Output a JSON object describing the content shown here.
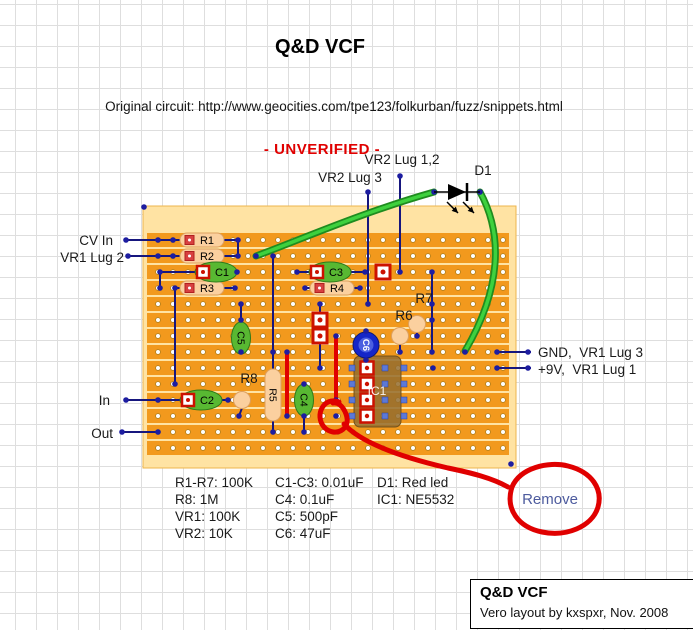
{
  "title": "Q&D VCF",
  "subtitle": "Original circuit: http://www.geocities.com/tpe123/folkurban/fuzz/snippets.html",
  "status": "- UNVERIFIED -",
  "remove_label": "Remove",
  "footer": {
    "title": "Q&D VCF",
    "credit": "Vero layout by kxspxr, Nov. 2008"
  },
  "parts_list": {
    "top": 474,
    "line_height": 17,
    "columns": [
      {
        "x": 175,
        "lines": [
          "R1-R7: 100K",
          "R8: 1M",
          "VR1: 100K",
          "VR2: 10K"
        ]
      },
      {
        "x": 275,
        "lines": [
          "C1-C3: 0.01uF",
          "C4: 0.1uF",
          "C5: 500pF",
          "C6: 47uF"
        ]
      },
      {
        "x": 377,
        "lines": [
          "D1: Red led",
          "IC1: NE5532"
        ]
      }
    ]
  },
  "colors": {
    "strip": "#f2991d",
    "board_band": "#ffe3a3",
    "board_edge": "#edb54e",
    "hole_stroke": "#aa7d1c",
    "wire": "#16167e",
    "dot": "#1d1da0",
    "green": "#3ed13e",
    "green_dark": "#1f8c1f",
    "red": "#e00000",
    "res_fill": "#fbd09f",
    "res_edge": "#dda05f",
    "res_marker": "#d84040",
    "cap_fill": "#58b832",
    "cap_edge": "#2f7a1a",
    "pad_red": "#cc1100",
    "ic_fill": "rgba(148,108,46,0.85)",
    "ic_edge": "rgba(105,75,25,0.9)",
    "ic_pin": "#5c79d6",
    "c6_outer": "#1526c8",
    "c6_inner": "#4b5fe0",
    "label": "#1a1a1a",
    "led": "#000000",
    "annotation": "#e00000"
  },
  "board": {
    "x": 143,
    "y": 206,
    "w": 373,
    "h": 262,
    "strip_x": 147,
    "strip_w": 362,
    "rows": 14,
    "first_row_y": 240,
    "row_pitch": 16,
    "cols": 24,
    "first_col_x": 158,
    "col_pitch": 15
  },
  "float_labels": [
    {
      "t": "VR2 Lug 1,2",
      "x": 402,
      "y": 164,
      "a": "middle"
    },
    {
      "t": "VR2 Lug 3",
      "x": 350,
      "y": 182,
      "a": "middle"
    },
    {
      "t": "D1",
      "x": 483,
      "y": 175,
      "a": "middle"
    },
    {
      "t": "CV In",
      "x": 113,
      "y": 245,
      "a": "end"
    },
    {
      "t": "VR1 Lug 2",
      "x": 124,
      "y": 262,
      "a": "end"
    },
    {
      "t": "In",
      "x": 110,
      "y": 405,
      "a": "end"
    },
    {
      "t": "Out",
      "x": 113,
      "y": 438,
      "a": "end"
    },
    {
      "t": "GND,  VR1 Lug 3",
      "x": 538,
      "y": 357,
      "a": "start"
    },
    {
      "t": "+9V,  VR1 Lug 1",
      "x": 538,
      "y": 374,
      "a": "start"
    },
    {
      "t": "R8",
      "x": 249,
      "y": 383,
      "a": "middle"
    },
    {
      "t": "R6",
      "x": 404,
      "y": 320,
      "a": "middle"
    },
    {
      "t": "R7",
      "x": 424,
      "y": 303,
      "a": "middle"
    }
  ],
  "wires": {
    "blue": [
      [
        126,
        240,
        238,
        240
      ],
      [
        128,
        256,
        238,
        256
      ],
      [
        126,
        400,
        228,
        400
      ],
      [
        122,
        432,
        158,
        432
      ],
      [
        497,
        352,
        531,
        352
      ],
      [
        497,
        368,
        531,
        368
      ],
      [
        368,
        192,
        368,
        304
      ],
      [
        400,
        176,
        400,
        272
      ],
      [
        238,
        240,
        238,
        256
      ],
      [
        160,
        272,
        160,
        288
      ],
      [
        175,
        288,
        175,
        384
      ],
      [
        273,
        256,
        273,
        432
      ],
      [
        241,
        304,
        241,
        352
      ],
      [
        320,
        304,
        320,
        368
      ],
      [
        304,
        384,
        304,
        432
      ],
      [
        432,
        272,
        432,
        352
      ],
      [
        366,
        329,
        366,
        336
      ],
      [
        366,
        352,
        366,
        361
      ],
      [
        158,
        272,
        237,
        272
      ],
      [
        297,
        272,
        365,
        272
      ],
      [
        175,
        288,
        235,
        288
      ],
      [
        305,
        288,
        360,
        288
      ],
      [
        242,
        408,
        239,
        416
      ],
      [
        400,
        344,
        400,
        351
      ],
      [
        417,
        332,
        417,
        337
      ]
    ],
    "green": [
      "M256,256 C300,240 360,213 434,192",
      "M480,192 C503,234 502,288 465,351"
    ],
    "red": [
      [
        287,
        352,
        287,
        416
      ],
      [
        336,
        336,
        336,
        400
      ]
    ],
    "dots": [
      [
        126,
        240
      ],
      [
        158,
        240
      ],
      [
        173,
        240
      ],
      [
        238,
        240
      ],
      [
        128,
        256
      ],
      [
        158,
        256
      ],
      [
        173,
        256
      ],
      [
        238,
        256
      ],
      [
        256,
        256
      ],
      [
        273,
        256
      ],
      [
        160,
        272
      ],
      [
        237,
        272
      ],
      [
        297,
        272
      ],
      [
        365,
        272
      ],
      [
        400,
        272
      ],
      [
        432,
        272
      ],
      [
        160,
        288
      ],
      [
        175,
        288
      ],
      [
        235,
        288
      ],
      [
        305,
        288
      ],
      [
        360,
        288
      ],
      [
        241,
        304
      ],
      [
        320,
        304
      ],
      [
        368,
        304
      ],
      [
        432,
        304
      ],
      [
        241,
        320
      ],
      [
        432,
        320
      ],
      [
        336,
        336
      ],
      [
        417,
        336
      ],
      [
        241,
        352
      ],
      [
        273,
        352
      ],
      [
        287,
        352
      ],
      [
        400,
        352
      ],
      [
        432,
        352
      ],
      [
        465,
        352
      ],
      [
        497,
        352
      ],
      [
        528,
        352
      ],
      [
        320,
        368
      ],
      [
        433,
        368
      ],
      [
        497,
        368
      ],
      [
        528,
        368
      ],
      [
        175,
        384
      ],
      [
        304,
        384
      ],
      [
        126,
        400
      ],
      [
        158,
        400
      ],
      [
        228,
        400
      ],
      [
        336,
        400
      ],
      [
        239,
        416
      ],
      [
        287,
        416
      ],
      [
        304,
        416
      ],
      [
        336,
        416
      ],
      [
        122,
        432
      ],
      [
        158,
        432
      ],
      [
        273,
        432
      ],
      [
        304,
        432
      ],
      [
        368,
        192
      ],
      [
        400,
        176
      ],
      [
        434,
        192
      ],
      [
        480,
        192
      ],
      [
        366,
        331
      ],
      [
        366,
        360
      ],
      [
        144,
        207
      ],
      [
        511,
        464
      ]
    ]
  },
  "components": {
    "resistors_h": [
      {
        "label": "R1",
        "x": 180,
        "y": 240
      },
      {
        "label": "R2",
        "x": 180,
        "y": 256
      },
      {
        "label": "R3",
        "x": 180,
        "y": 288
      },
      {
        "label": "R4",
        "x": 310,
        "y": 288
      }
    ],
    "caps_h": [
      {
        "label": "C1",
        "cx": 216,
        "cy": 272
      },
      {
        "label": "C3",
        "cx": 330,
        "cy": 272
      },
      {
        "label": "C2",
        "cx": 201,
        "cy": 400
      }
    ],
    "caps_v": [
      {
        "label": "C5",
        "cx": 241,
        "cy": 338
      },
      {
        "label": "C4",
        "cx": 304,
        "cy": 400
      }
    ],
    "resistor_v": {
      "label": "R5",
      "cx": 273,
      "cy": 395
    },
    "round_parts": [
      {
        "label": "R8",
        "cx": 242,
        "cy": 400
      },
      {
        "label": "R6",
        "cx": 400,
        "cy": 336
      },
      {
        "label": "R7",
        "cx": 417,
        "cy": 324
      }
    ],
    "ic": {
      "label": "IC1",
      "x": 354,
      "y": 356,
      "w": 47,
      "h": 71,
      "pad_rows": [
        368,
        384,
        400,
        416
      ],
      "red_col": 367,
      "pin_cols": [
        352,
        385,
        404
      ]
    },
    "c6": {
      "label": "C6",
      "cx": 366,
      "cy": 345
    },
    "red_pads": [
      [
        320,
        320
      ],
      [
        320,
        336
      ],
      [
        383,
        272
      ]
    ],
    "led": {
      "label": "D1",
      "x1": 434,
      "x2": 480,
      "y": 192,
      "arrows": [
        [
          447,
          202,
          458,
          213
        ],
        [
          463,
          202,
          474,
          213
        ]
      ]
    }
  },
  "annotation": {
    "loop": "M339,402 C324,396 314,415 324,427 C334,438 352,430 346,414 C343,406 338,402 333,403",
    "tail": "M344,424 C362,444 405,458 448,468 C472,473 492,478 508,487",
    "ellipse": "M512,487 C520,468 548,461 568,466 C592,472 603,489 598,507 C592,527 566,537 542,532 C518,527 505,509 512,487"
  }
}
